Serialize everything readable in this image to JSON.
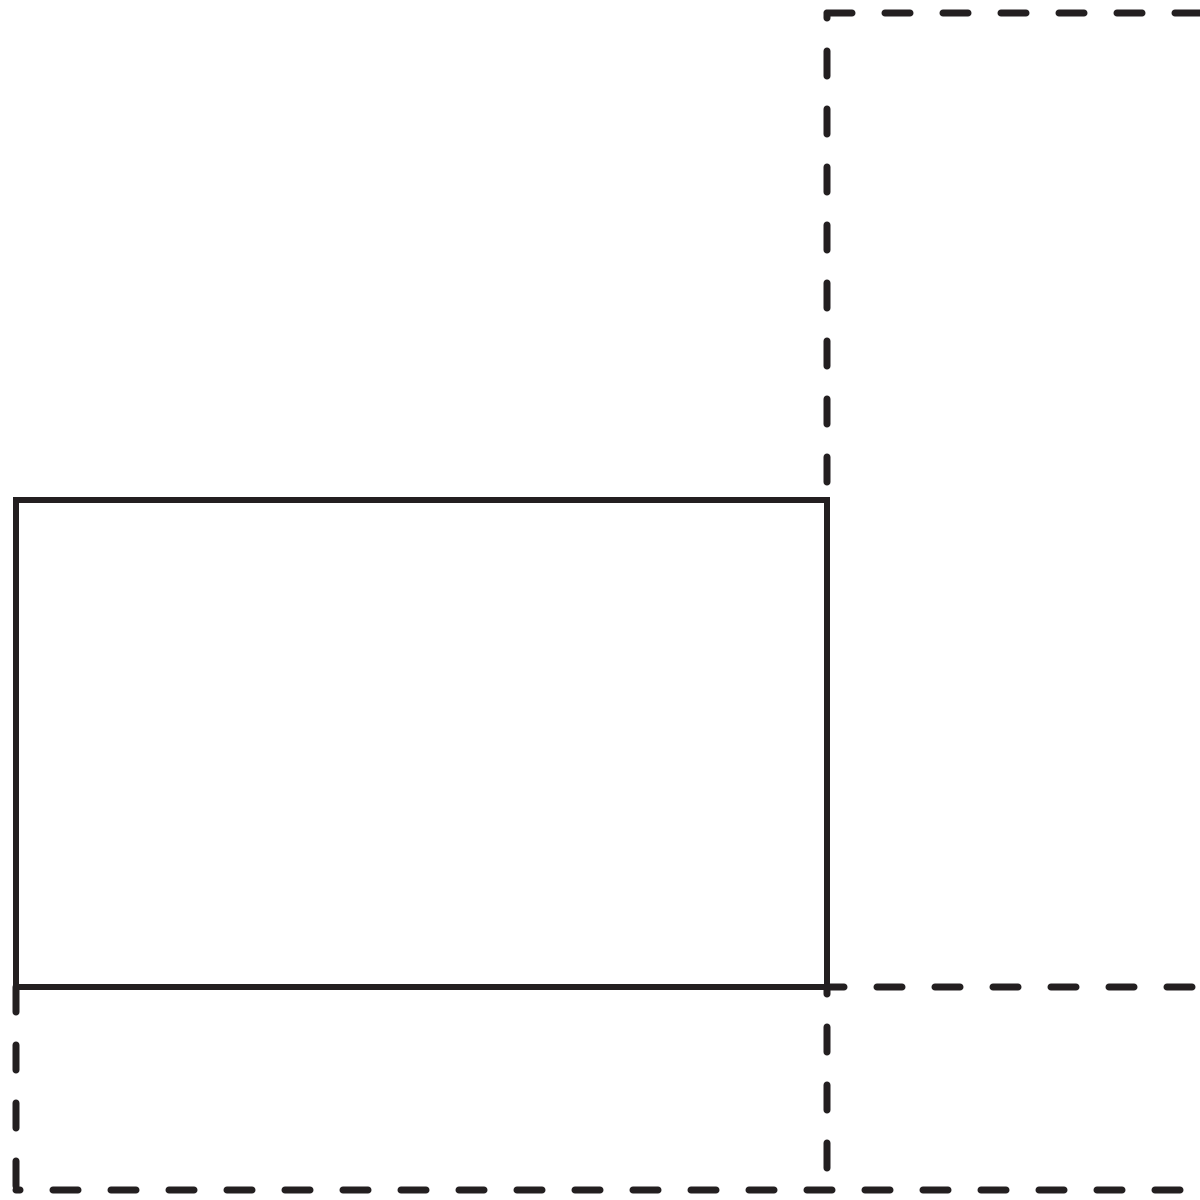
{
  "figure": {
    "description": "geometric-diagram-solid-rectangle-with-dashed-rectangles",
    "canvas": {
      "width": 1200,
      "height": 1200
    },
    "background_color": "#ffffff",
    "stroke_color": "#231f20",
    "solid_stroke_width": 6,
    "dashed_stroke_width": 7,
    "dash_pattern": "25 33",
    "shapes": [
      {
        "type": "rect",
        "name": "solid-rectangle",
        "x": 16,
        "y": 500,
        "width": 811,
        "height": 487,
        "dashed": false
      },
      {
        "type": "line",
        "name": "dashed-top-horizontal-line",
        "x1": 827,
        "y1": 13,
        "x2": 1200,
        "y2": 13,
        "dashed": true,
        "dash_offset": 0
      },
      {
        "type": "line",
        "name": "dashed-top-vertical-line",
        "x1": 827,
        "y1": 13,
        "x2": 827,
        "y2": 490,
        "dashed": true,
        "dash_offset": 20
      },
      {
        "type": "line",
        "name": "dashed-right-horizontal-line",
        "x1": 827,
        "y1": 987,
        "x2": 1200,
        "y2": 987,
        "dashed": true,
        "dash_offset": 8
      },
      {
        "type": "line",
        "name": "dashed-bottom-left-vertical-line",
        "x1": 16,
        "y1": 987,
        "x2": 16,
        "y2": 1190,
        "dashed": true,
        "dash_offset": 0
      },
      {
        "type": "line",
        "name": "dashed-bottom-horizontal-line",
        "x1": 16,
        "y1": 1190,
        "x2": 1200,
        "y2": 1190,
        "dashed": true,
        "dash_offset": 21
      },
      {
        "type": "line",
        "name": "dashed-bottom-right-vertical-line",
        "x1": 827,
        "y1": 987,
        "x2": 827,
        "y2": 1190,
        "dashed": true,
        "dash_offset": 18
      }
    ]
  }
}
